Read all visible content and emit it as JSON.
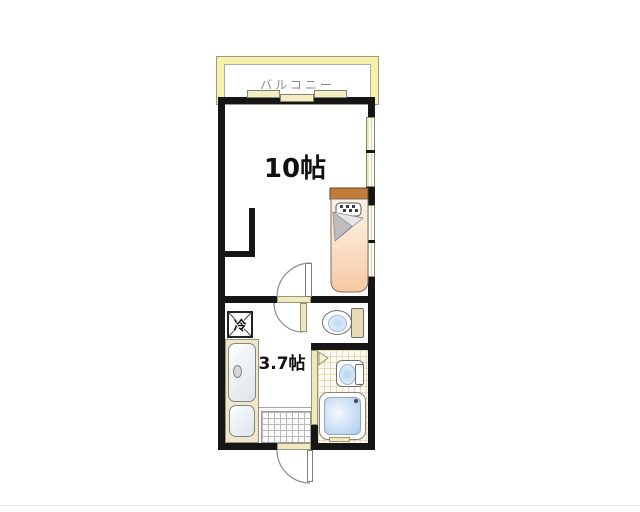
{
  "floorplan": {
    "type": "japanese-apartment-floor-plan",
    "balcony": {
      "label": "バルコニー"
    },
    "main_room": {
      "label": "10帖"
    },
    "kitchen_room": {
      "label": "3.7帖"
    },
    "refrigerator": {
      "label": "冷"
    },
    "colors": {
      "wall": "#161616",
      "balcony_frame": "#f5f1a8",
      "fittings_beige": "#efe7c0",
      "water_blue": "#a9c9ee",
      "bed_cover": "#f5c8a2",
      "bed_headboard": "#b06f2e",
      "bath_tile_line": "#e2dab8",
      "label_gray": "#8a8a8a"
    }
  }
}
